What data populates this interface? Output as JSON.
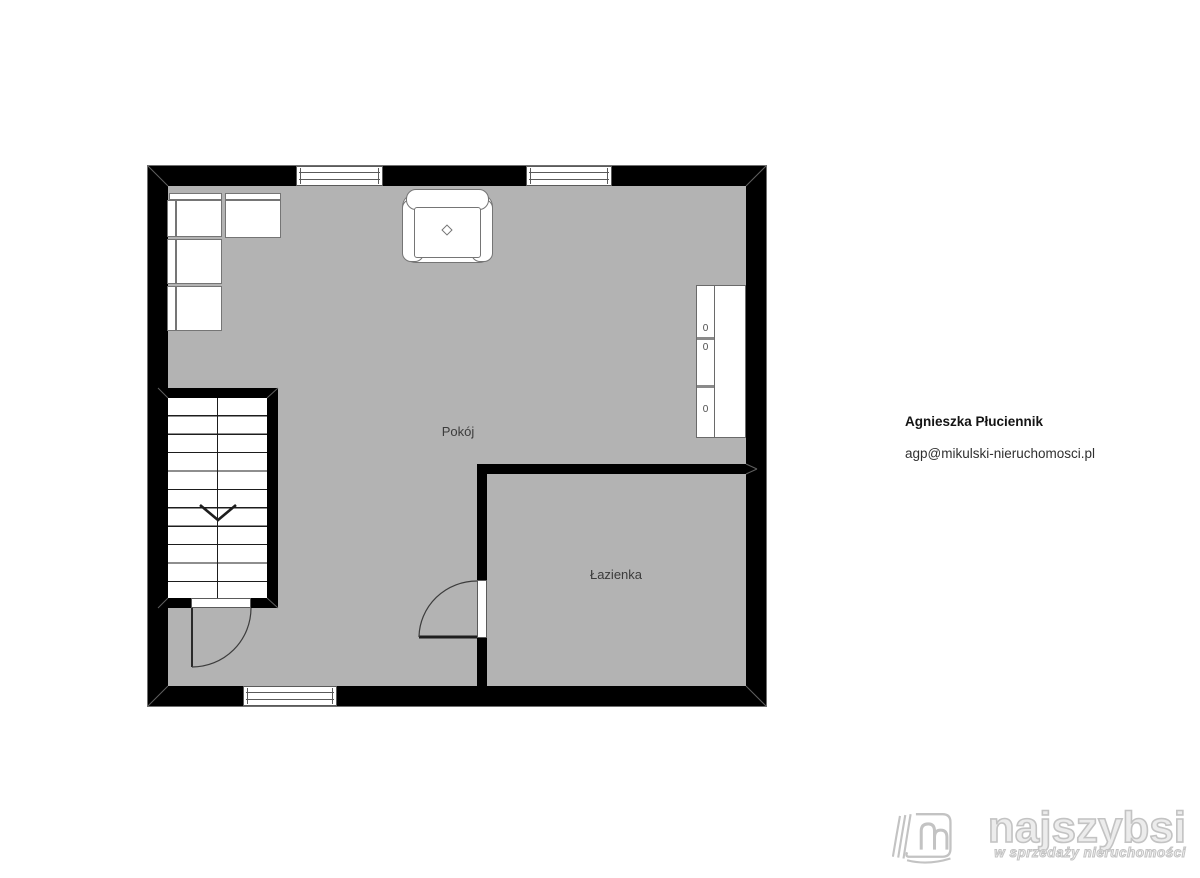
{
  "floorplan": {
    "rooms": [
      {
        "label": "Pokój"
      },
      {
        "label": "Łazienka"
      }
    ],
    "stairs": {
      "direction": "down"
    },
    "wardrobe": {
      "shelf_labels": [
        "0",
        "0",
        "0"
      ]
    }
  },
  "contact": {
    "name": "Agnieszka Płuciennik",
    "email": "agp@mikulski-nieruchomosci.pl"
  },
  "logo": {
    "brand": "najszybsi",
    "tagline": "w sprzedaży nieruchomości"
  },
  "colors": {
    "floor": "#b3b3b3",
    "wall": "#000000",
    "furniture_outline": "#757575",
    "label_text": "#3c3c3c",
    "logo_gray": "#c3c3c3"
  }
}
